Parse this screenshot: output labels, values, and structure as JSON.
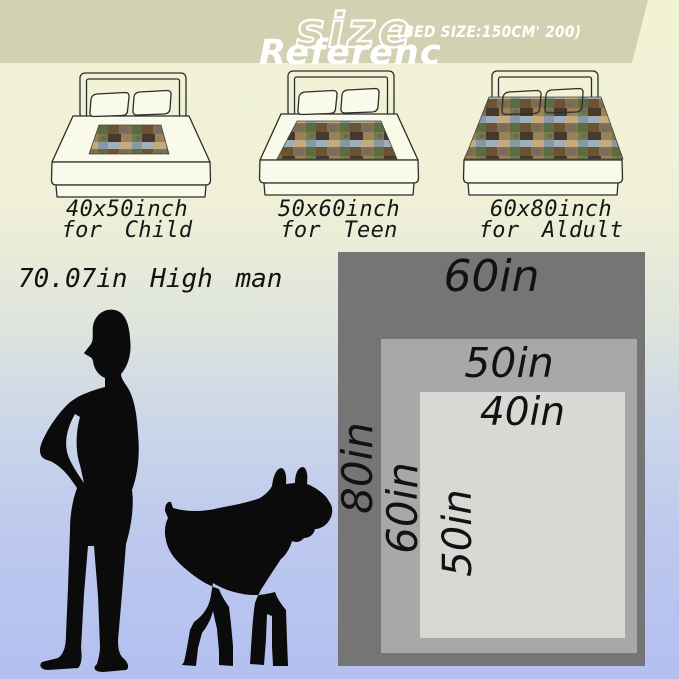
{
  "title_block": {
    "size_title": "size",
    "bed_size_note": "(BED SIZE:150CM' 200)",
    "reference_label": "Referenc"
  },
  "bed_options": [
    {
      "dimensions": "40x50inch",
      "audience": "for Child"
    },
    {
      "dimensions": "50x60inch",
      "audience": "for Teen"
    },
    {
      "dimensions": "60x80inch",
      "audience": "for Aldult"
    }
  ],
  "comparison": {
    "man_height_note": "70.07in High man"
  },
  "size_diagram": {
    "rects": [
      {
        "width_label": "60in",
        "height_label": "80in",
        "color": "#757575"
      },
      {
        "width_label": "50in",
        "height_label": "60in",
        "color": "#a8a8a8"
      },
      {
        "width_label": "40in",
        "height_label": "50in",
        "color": "#d8d8d5"
      }
    ]
  },
  "palette": {
    "header_band": "#d2d2b3",
    "background_top": "#f2f3d5",
    "background_bottom": "#b3c0f0",
    "silhouette": "#0b0b0b",
    "text": "#121212",
    "blanket_browns": [
      "#87704a",
      "#6b5233",
      "#46382a"
    ],
    "blanket_greens": [
      "#5d6b40",
      "#717c4b"
    ],
    "blanket_sky": "#9fb0bd"
  }
}
